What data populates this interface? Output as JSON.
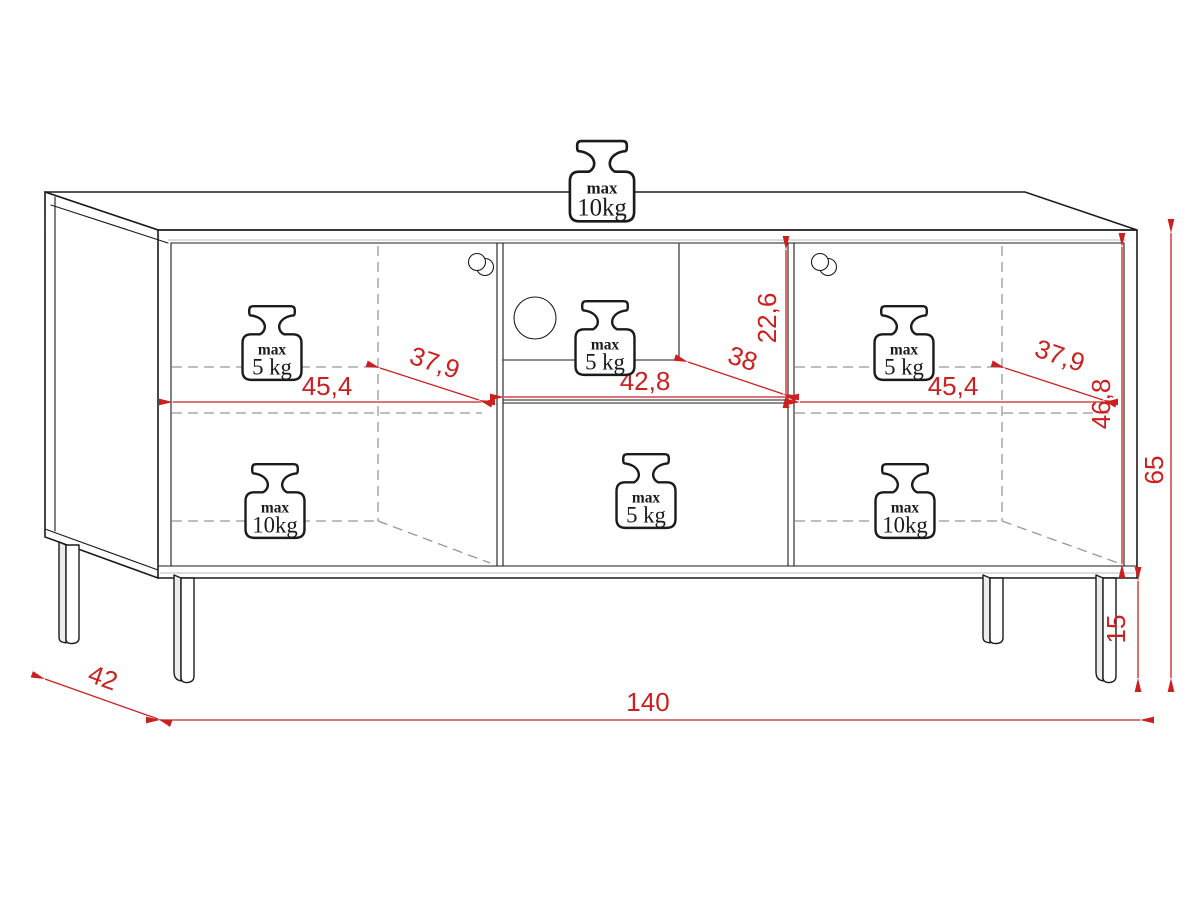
{
  "diagram": {
    "description": "TV cabinet technical dimension drawing",
    "colors": {
      "outline": "#1b1b1b",
      "hidden_line": "#979797",
      "dimension": "#cc2020"
    },
    "labels": {
      "width_total": "140",
      "depth_total": "42",
      "height_total": "65",
      "leg_height": "15",
      "interior_height": "46,8",
      "niche_height": "22,6",
      "niche_width": "42,8",
      "niche_depth": "38",
      "compartment_width": "45,4",
      "compartment_depth": "37,9"
    },
    "load": {
      "max_label": "max",
      "value_5kg": "5 kg",
      "value_10kg": "10kg"
    }
  }
}
